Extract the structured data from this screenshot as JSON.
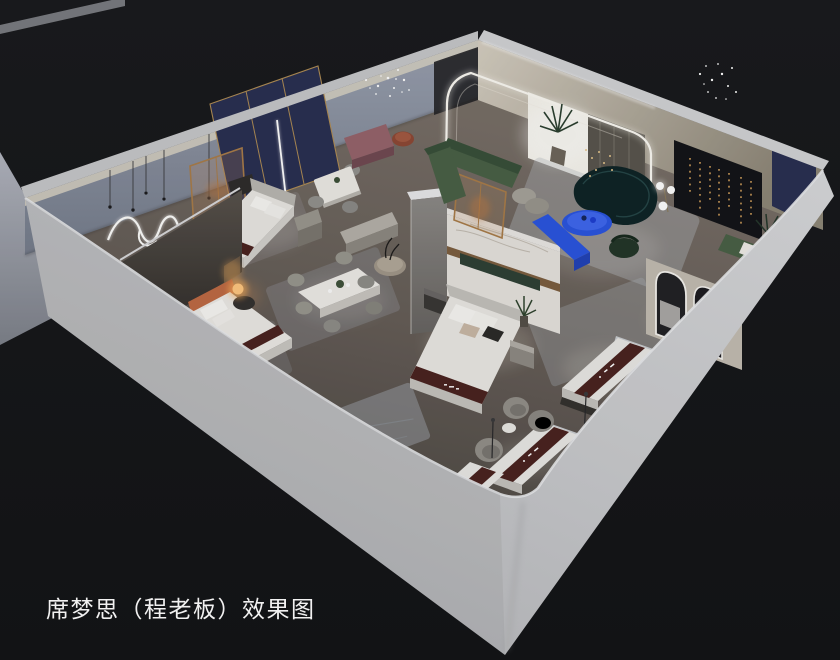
{
  "caption": {
    "text": "席梦思（程老板）效果图"
  },
  "scene": {
    "type": "isometric-cutaway-interior-render",
    "areas": [
      "bedroom-display-back-left",
      "bedroom-display-left",
      "bedroom-display-center",
      "dining-display-center",
      "living-room-display",
      "lounge-display-right",
      "mattress-gallery-front"
    ],
    "objects": [
      "wavy-neon-wall-light",
      "pendant-lights",
      "navy-wall-panels",
      "bronze-glass-screens",
      "bed-with-navy-headboard",
      "bed-with-orange-headboard",
      "bed-with-marble-headwall",
      "glowing-sphere-lamp",
      "square-dining-table",
      "long-dining-table",
      "round-side-table",
      "green-sectional-sofa",
      "curved-teal-sofa",
      "blue-oval-coffee-table",
      "blue-tv-console",
      "sphere-floor-lamp",
      "scatter-chandeliers",
      "led-arch-cove",
      "dark-media-wall",
      "gold-string-lights",
      "arched-led-mirrors",
      "mattress-displays-with-brand-runners",
      "swivel-armchairs",
      "cylinder-floor-lamps",
      "area-rugs",
      "potted-palms"
    ]
  },
  "colors": {
    "background": "#17181a",
    "wall_exterior": "#cdced1",
    "wall_back_left": "#8d94a3",
    "wall_back_right": "#c9c2b4",
    "floor_wood": "#6e665f",
    "accent_blue": "#2b55e0",
    "sofa_teal": "#0f2527",
    "sofa_green": "#4a6147",
    "mattress_runner": "#4b2420",
    "navy_panel": "#2a3052",
    "orange_accent": "#bf6b44",
    "warm_lamp": "#ffb35c",
    "led_white": "#f7f5ee",
    "caption_text": "#f1f1f1"
  }
}
